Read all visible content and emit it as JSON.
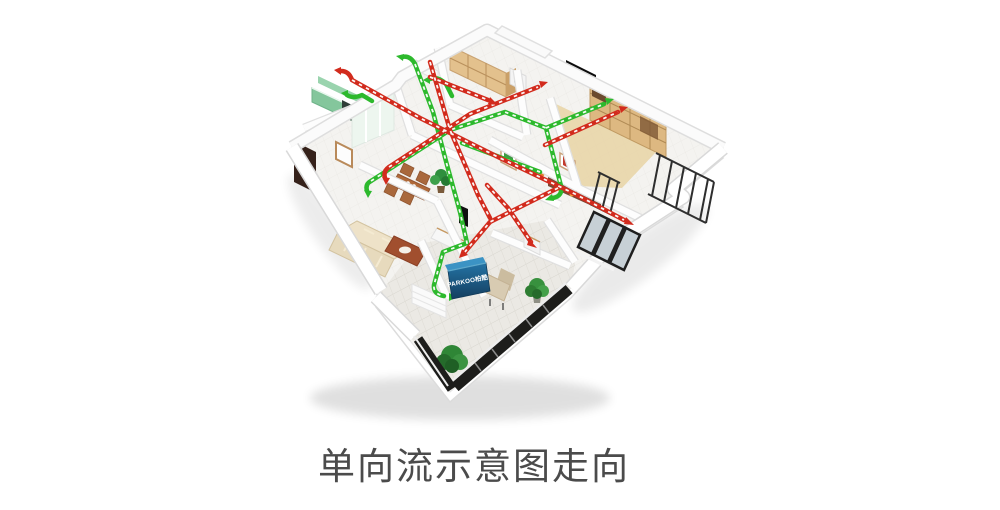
{
  "caption": {
    "text": "单向流示意图走向"
  },
  "ventilation_unit": {
    "brand_label": "PARKOO柏酷"
  },
  "colors": {
    "supply_duct_green": "#2db92d",
    "exhaust_duct_red": "#d22b1d",
    "unit_body_blue": "#1d6ea0",
    "caption_text": "#4b4b4b",
    "background": "#ffffff"
  }
}
